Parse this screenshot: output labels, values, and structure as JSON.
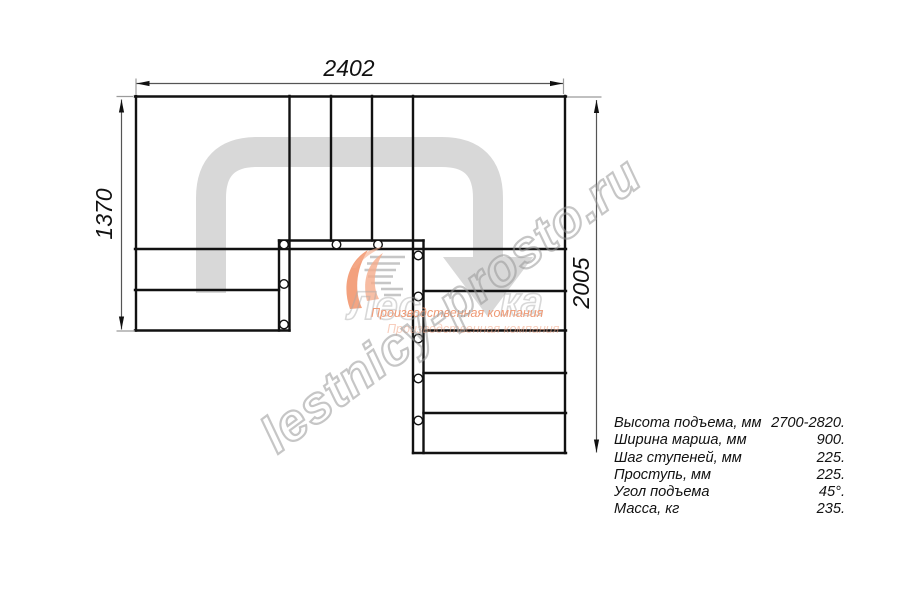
{
  "drawing": {
    "dim_top": "2402",
    "dim_left": "1370",
    "dim_right": "2005"
  },
  "watermark": {
    "site": "lestnicy-prosto.ru",
    "brand_part_left": "Лес",
    "brand_part_right": "ка",
    "company_line1": "Производственная компания",
    "company_line2": "Производственная компания"
  },
  "specs": {
    "rows": [
      {
        "label": "Высота подъема, мм",
        "value": "2700-2820."
      },
      {
        "label": "Ширина марша, мм",
        "value": "900."
      },
      {
        "label": "Шаг ступеней, мм",
        "value": "225."
      },
      {
        "label": "Проступь, мм",
        "value": "225."
      },
      {
        "label": "Угол подъема",
        "value": "45°."
      },
      {
        "label": "Масса, кг",
        "value": "235."
      }
    ]
  },
  "colors": {
    "line": "#111111",
    "dimension_line": "#555555",
    "extension_line": "#9b9b9b",
    "route_arrow": "#d8d8d8",
    "logo_orange": "#f08a5c",
    "logo_orange_light": "#f5ab8b",
    "watermark_gray": "#989898"
  }
}
